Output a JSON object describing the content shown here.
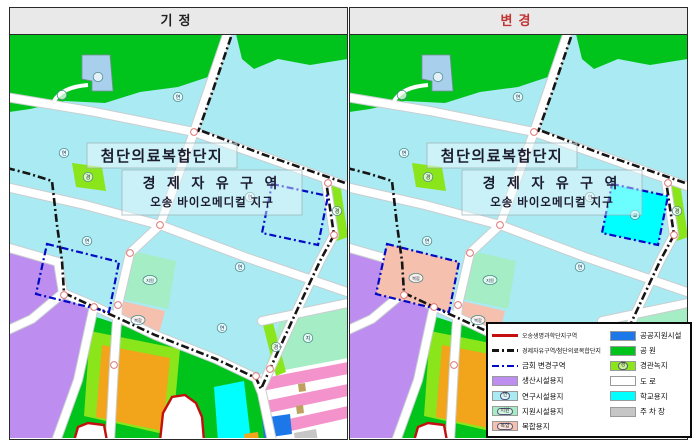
{
  "panels": [
    {
      "title": "기정",
      "title_color": "#222222",
      "variant": "before"
    },
    {
      "title": "변경",
      "title_color": "#c03434",
      "variant": "after"
    }
  ],
  "map_labels": {
    "complex": "첨단의료복합단지",
    "zone": "경 제 자 유 구 역",
    "district": "오송 바이오메디컬 지구"
  },
  "badges": {
    "research": "연",
    "support": "지원",
    "support_short": "지",
    "mixed": "복합",
    "landscape": "경",
    "school": "교"
  },
  "colors": {
    "research_base": "#aaeaf2",
    "park": "#00c41c",
    "landscape_green": "#8ae51a",
    "support_mint": "#a4edc5",
    "mixed_pink": "#f5c1ae",
    "residential_pink": "#f492cc",
    "production_purple": "#bd8ef0",
    "orange_block": "#f2a41a",
    "school_cyan": "#00ffff",
    "public_blue": "#1c78e8",
    "parking_gray": "#c6c6c6",
    "facility_blue": "#a8d0ec",
    "road_white": "#ffffff",
    "road_casing": "#c9ced0",
    "boundary_red": "#c40f0f",
    "boundary_black": "#151515",
    "boundary_blue": "#0009c4"
  },
  "legend": {
    "col1": [
      {
        "type": "line",
        "style": "solid",
        "color": "#c40f0f",
        "label": "오송생명과학단지구역"
      },
      {
        "type": "line",
        "style": "dashdot",
        "color": "#151515",
        "label": "경제자유구역/첨단의료복합단지"
      },
      {
        "type": "line",
        "style": "dashdot",
        "color": "#0009c4",
        "label": "금회 변경구역"
      },
      {
        "type": "fill",
        "color": "#bd8ef0",
        "badge": "",
        "label": "생산시설용지"
      },
      {
        "type": "fill",
        "color": "#aaeaf2",
        "badge": "연",
        "label": "연구시설용지"
      },
      {
        "type": "fill",
        "color": "#a4edc5",
        "badge": "지원",
        "label": "지원시설용지"
      },
      {
        "type": "fill",
        "color": "#f5c1ae",
        "badge": "복합",
        "label": "복합용지"
      }
    ],
    "col2": [
      {
        "type": "fill",
        "color": "#1c78e8",
        "badge": "",
        "label": "공공지원시설"
      },
      {
        "type": "fill",
        "color": "#00c41c",
        "badge": "",
        "label": "공 원"
      },
      {
        "type": "fill",
        "color": "#8ae51a",
        "badge": "경",
        "label": "경관녹지"
      },
      {
        "type": "fill",
        "color": "#ffffff",
        "badge": "",
        "label": "도 로"
      },
      {
        "type": "fill",
        "color": "#00ffff",
        "badge": "",
        "label": "학교용지"
      },
      {
        "type": "fill",
        "color": "#c6c6c6",
        "badge": "",
        "label": "주 차 장"
      }
    ]
  }
}
